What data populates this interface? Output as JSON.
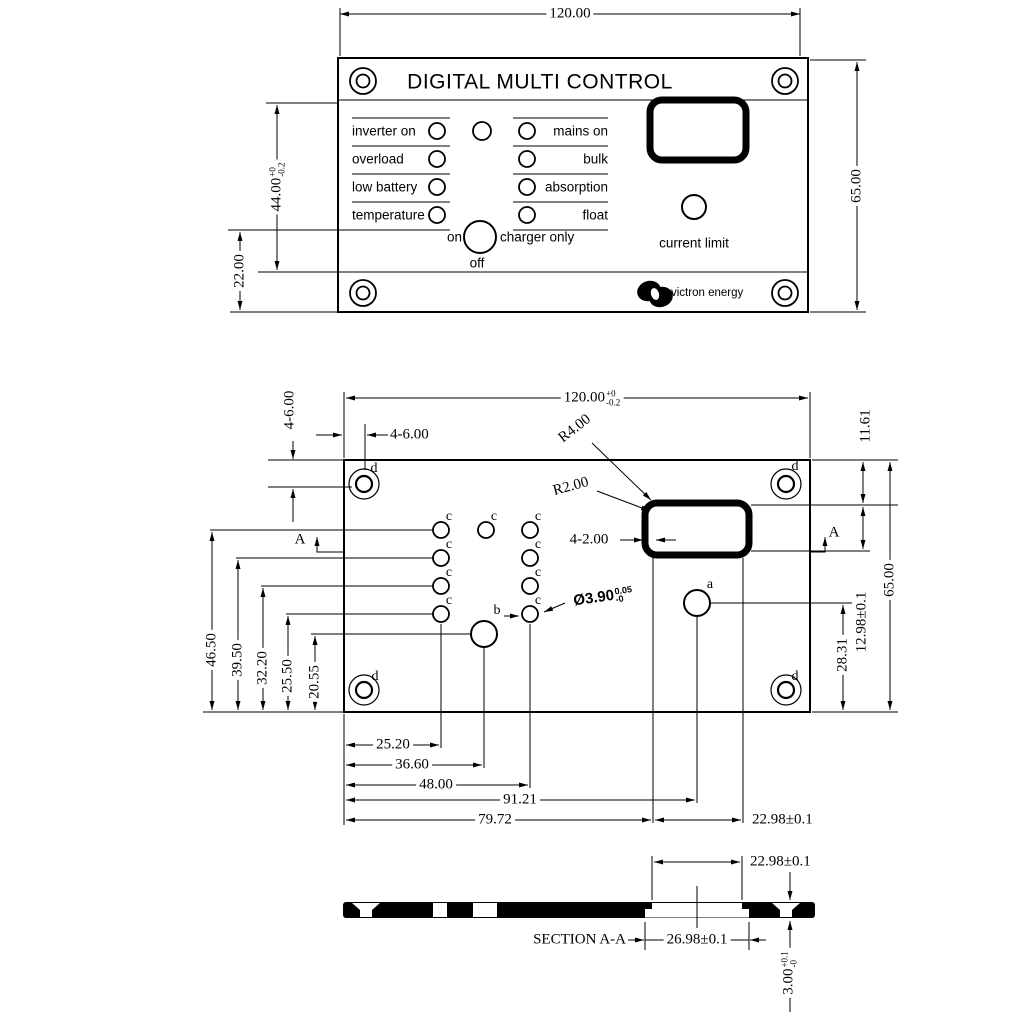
{
  "front": {
    "width_dim": "120.00",
    "height_dim": "65.00",
    "led_area_dim": {
      "value": "44.00",
      "tol_top": "+0",
      "tol_bottom": "-0.2"
    },
    "switch_dim": "22.00",
    "title": "DIGITAL MULTI CONTROL",
    "leds_left": [
      {
        "label": "inverter on"
      },
      {
        "label": "overload"
      },
      {
        "label": "low battery"
      },
      {
        "label": "temperature"
      }
    ],
    "leds_right": [
      {
        "label": "mains on"
      },
      {
        "label": "bulk"
      },
      {
        "label": "absorption"
      },
      {
        "label": "float"
      }
    ],
    "switch": {
      "on": "on",
      "off": "off",
      "charger_only": "charger only"
    },
    "current_limit": "current limit",
    "brand": "victron energy"
  },
  "plate": {
    "width_dim": {
      "value": "120.00",
      "tol_top": "+0",
      "tol_bottom": "-0.2"
    },
    "corner_dim_v": "4-6.00",
    "corner_dim_h": "4-6.00",
    "radius_outer": "R4.00",
    "radius_inner": "R2.00",
    "wall_dim": "4-2.00",
    "hole_dia": {
      "value": "Ø3.90",
      "tol_top": "0.05",
      "tol_bottom": "-0"
    },
    "left_dims": [
      "46.50",
      "39.50",
      "32.20",
      "25.50",
      "20.55"
    ],
    "top_right_dim": "11.61",
    "cutout_height_dim": "12.98±0.1",
    "hole_a_dim": "28.31",
    "height_dim": "65.00",
    "bottom_dims": [
      "25.20",
      "36.60",
      "48.00",
      "91.21",
      "79.72"
    ],
    "cutout_width_dim": "22.98±0.1",
    "labels": {
      "a": "a",
      "b": "b",
      "c": "c",
      "d": "d"
    },
    "section_mark": "A"
  },
  "section": {
    "label": "SECTION A-A",
    "top_width_dim": "22.98±0.1",
    "bottom_width_dim": "26.98±0.1",
    "thickness_dim": {
      "value": "3.00",
      "tol_top": "+0.1",
      "tol_bottom": "-0"
    }
  }
}
